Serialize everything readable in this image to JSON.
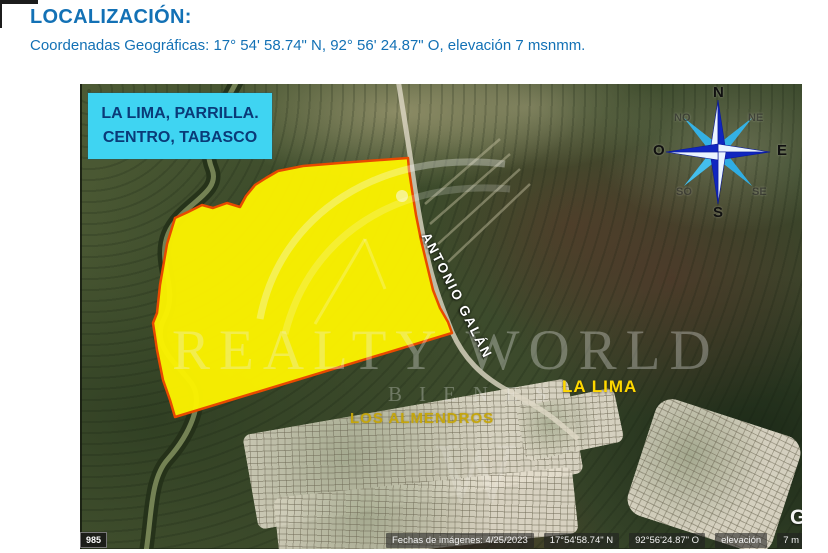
{
  "page": {
    "title": "LOCALIZACIÓN:",
    "subtitle": "Coordenadas Geográficas:   17° 54' 58.74\" N, 92° 56' 24.87\" O, elevación 7 msnmm."
  },
  "colors": {
    "heading_blue": "#1371b5",
    "callout_cyan": "#3fd4f2",
    "callout_text_navy": "#0a3a78",
    "parcel_fill_yellow": "#fcf300",
    "parcel_border_red": "#e84a00",
    "town_label_yellow": "#ffd900",
    "hood_label_olive": "#c6a60a",
    "compass_dark_blue": "#1026c0",
    "compass_light_blue": "#54ccf4"
  },
  "map": {
    "callout": {
      "line1": "LA LIMA, PARRILLA.",
      "line2": "CENTRO, TABASCO"
    },
    "labels": {
      "road": "ANTONIO GALÁN",
      "town": "LA LIMA",
      "neighborhood": "LOS ALMENDROS"
    },
    "compass": {
      "n": "N",
      "s": "S",
      "e": "E",
      "o": "O",
      "ne": "NE",
      "se": "SE",
      "so": "SO",
      "no": "NO"
    },
    "watermark": {
      "brand": "REALTY WORLD",
      "sub": "BIENES",
      "ghost": "W"
    },
    "statusbar": {
      "dates": "Fechas de imágenes: 4/25/2023",
      "lat": "17°54'58.74\" N",
      "lon": "92°56'24.87\" O",
      "elev_label": "elevación",
      "elev_value": "7 m",
      "alt": "alt"
    },
    "badge": "985",
    "logo_partial": "G"
  }
}
